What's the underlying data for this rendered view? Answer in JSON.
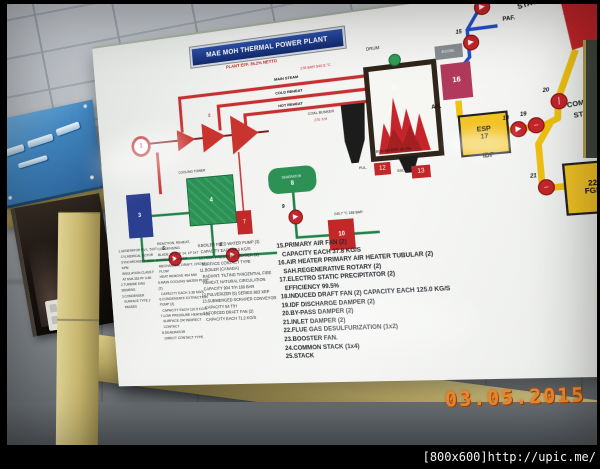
{
  "photo": {
    "date_stamp": "03.05.2015",
    "watermark": "[800x600]http://upic.me/"
  },
  "board": {
    "title": "MAE MOH THERMAL POWER PLANT",
    "subtitle": "PLANT EFF. 35.2% NETTO",
    "labels": {
      "drum": "DRUM",
      "main_steam": "MAIN STEAM",
      "cold_reheat": "COLD REHEAT",
      "hot_reheat": "HOT REHEAT",
      "steam_values": "178 BAR  540.5 °C",
      "boiler_eff": "BOILER EFF. 90.2%",
      "boiler_eff_value": "90.2",
      "coal_bunker": "COAL BUNKER",
      "coal_bunker_cap": "270 T/H",
      "pul": "PUL.",
      "ssc": "SSC.",
      "econ": "ECON.",
      "ah": "AH.",
      "paf": "PAF.",
      "esp": "ESP",
      "idf": "IDF",
      "stack": "STACK",
      "common_1": "COMMON",
      "common_2": "STACK",
      "fgd": "FGD",
      "buf": "BUF",
      "cooling_tower": "COOLING TOWER",
      "deaerator": "DEAERATOR",
      "feed_values": "240.7 °C  188 BAR",
      "turbine_num": "2"
    },
    "component_numbers": {
      "generator": "1",
      "condenser": "3",
      "cooling_tower": "4",
      "lp_heater": "7",
      "deaerator": "8",
      "hp_heater": "10",
      "boiler": "11",
      "pulverizer": "12",
      "scraper": "13",
      "air_heater": "16",
      "esp": "17",
      "fgd": "22",
      "common_stack": "24",
      "stack": "25"
    },
    "pumps_fans_dampers": [
      {
        "id": "mcw-pump-5",
        "num": "5",
        "glyph": "▶",
        "x": 76,
        "y": 230
      },
      {
        "id": "cep-pump-6",
        "num": "6",
        "glyph": "▶",
        "x": 140,
        "y": 230
      },
      {
        "id": "bfp-pump-9",
        "num": "9",
        "glyph": "▶",
        "x": 210,
        "y": 196
      },
      {
        "id": "paf-fan-15",
        "num": "15",
        "glyph": "▶",
        "x": 396,
        "y": 44
      },
      {
        "id": "paf-fan-15b",
        "num": "15",
        "glyph": "▶",
        "x": 409,
        "y": 12
      },
      {
        "id": "idf-fan-18",
        "num": "18",
        "glyph": "▶",
        "x": 432,
        "y": 130
      },
      {
        "id": "idf-damper-19",
        "num": "19",
        "glyph": "–",
        "x": 448,
        "y": 128
      },
      {
        "id": "bypass-damper-20",
        "num": "20",
        "glyph": "|",
        "x": 470,
        "y": 108
      },
      {
        "id": "inlet-damper-21",
        "num": "21",
        "glyph": "–",
        "x": 452,
        "y": 186
      },
      {
        "id": "booster-fan-23",
        "num": "23",
        "glyph": "▶",
        "x": 526,
        "y": 184
      }
    ],
    "specs": {
      "col1": [
        "1.GENERATOR P.V.L. 510T",
        "CYLINDRICAL ROTOR",
        "SYNCHRONIZED 3000 RPM",
        "INSULATION CLASS F",
        "AT MVA 353 PF 0.85",
        "2.TURBINE KWU SIEMENS",
        "3.CONDENSER",
        "SURFACE TYPE 2 PASSES"
      ],
      "col2": [
        "REACTION, REHEAT, CONDENSING",
        "BLADE HP & IP 14, LP 2x7",
        "4.COOLING TOWER",
        "MECHANICAL DRAFT, CROSS FLOW",
        "HEAT REMOVE 464 MW",
        "5.MAIN COOLING WATER PUMP (2)",
        "CAPACITY EACH 3.36 M3/S",
        "6.CONDENSATE EXTRACTION PUMP (2)",
        "CAPACITY EACH 119.9 KG/S",
        "7.LOW PRESSURE HEATER (3)",
        "SURFACE OR INDIRECT CONTACT",
        "8.DEAERATOR",
        "DIRECT CONTACT TYPE"
      ],
      "col3": [
        "9.BOILER FEED WATER PUMP (3)",
        "CAPACITY EACH 87.5 KG/S",
        "10.HIGH PRESSURE HEATER (3)",
        "SURFACE CONTACT TYPE",
        "11.BOILER (CANADA)",
        "RADIANT, TILTING TANGENTIAL FIRE",
        "REHEAT, NATURAL CIRCULATION",
        "CAPACITY 904 T/H 169 BAR",
        "12.PULVERIZER (5) SERIES 983 XRP",
        "13.SUBMERGED SCRAPER CONVEYOR",
        "CAPACITY 54 T/H",
        "14.FORCED DRAFT FAN (2)",
        "CAPACITY EACH 71.2 KG/S"
      ],
      "col4": [
        "15.PRIMARY AIR FAN (2)",
        "CAPACITY EACH 37.8 KG/S",
        "16.AIR HEATER PRIMARY AIR HEATER TUBULAR (2)",
        "SAH.REGENERATIVE ROTARY (2)",
        "17.ELECTRO STATIC PRECIPITATOR (2)",
        "EFFICIENCY 99.5%",
        "18.INDUCED DRAFT FAN (2) CAPACITY EACH 125.0 KG/S",
        "19.IDF DISCHARGE DAMPER (2)",
        "20.BY-PASS DAMPER (2)",
        "21.INLET DAMPER (2)",
        "22.FLUE GAS DESULFURIZATION (1x2)",
        "23.BOOSTER FAN.",
        "24.COMMON STACK (1x4)",
        "25.STACK"
      ]
    }
  }
}
